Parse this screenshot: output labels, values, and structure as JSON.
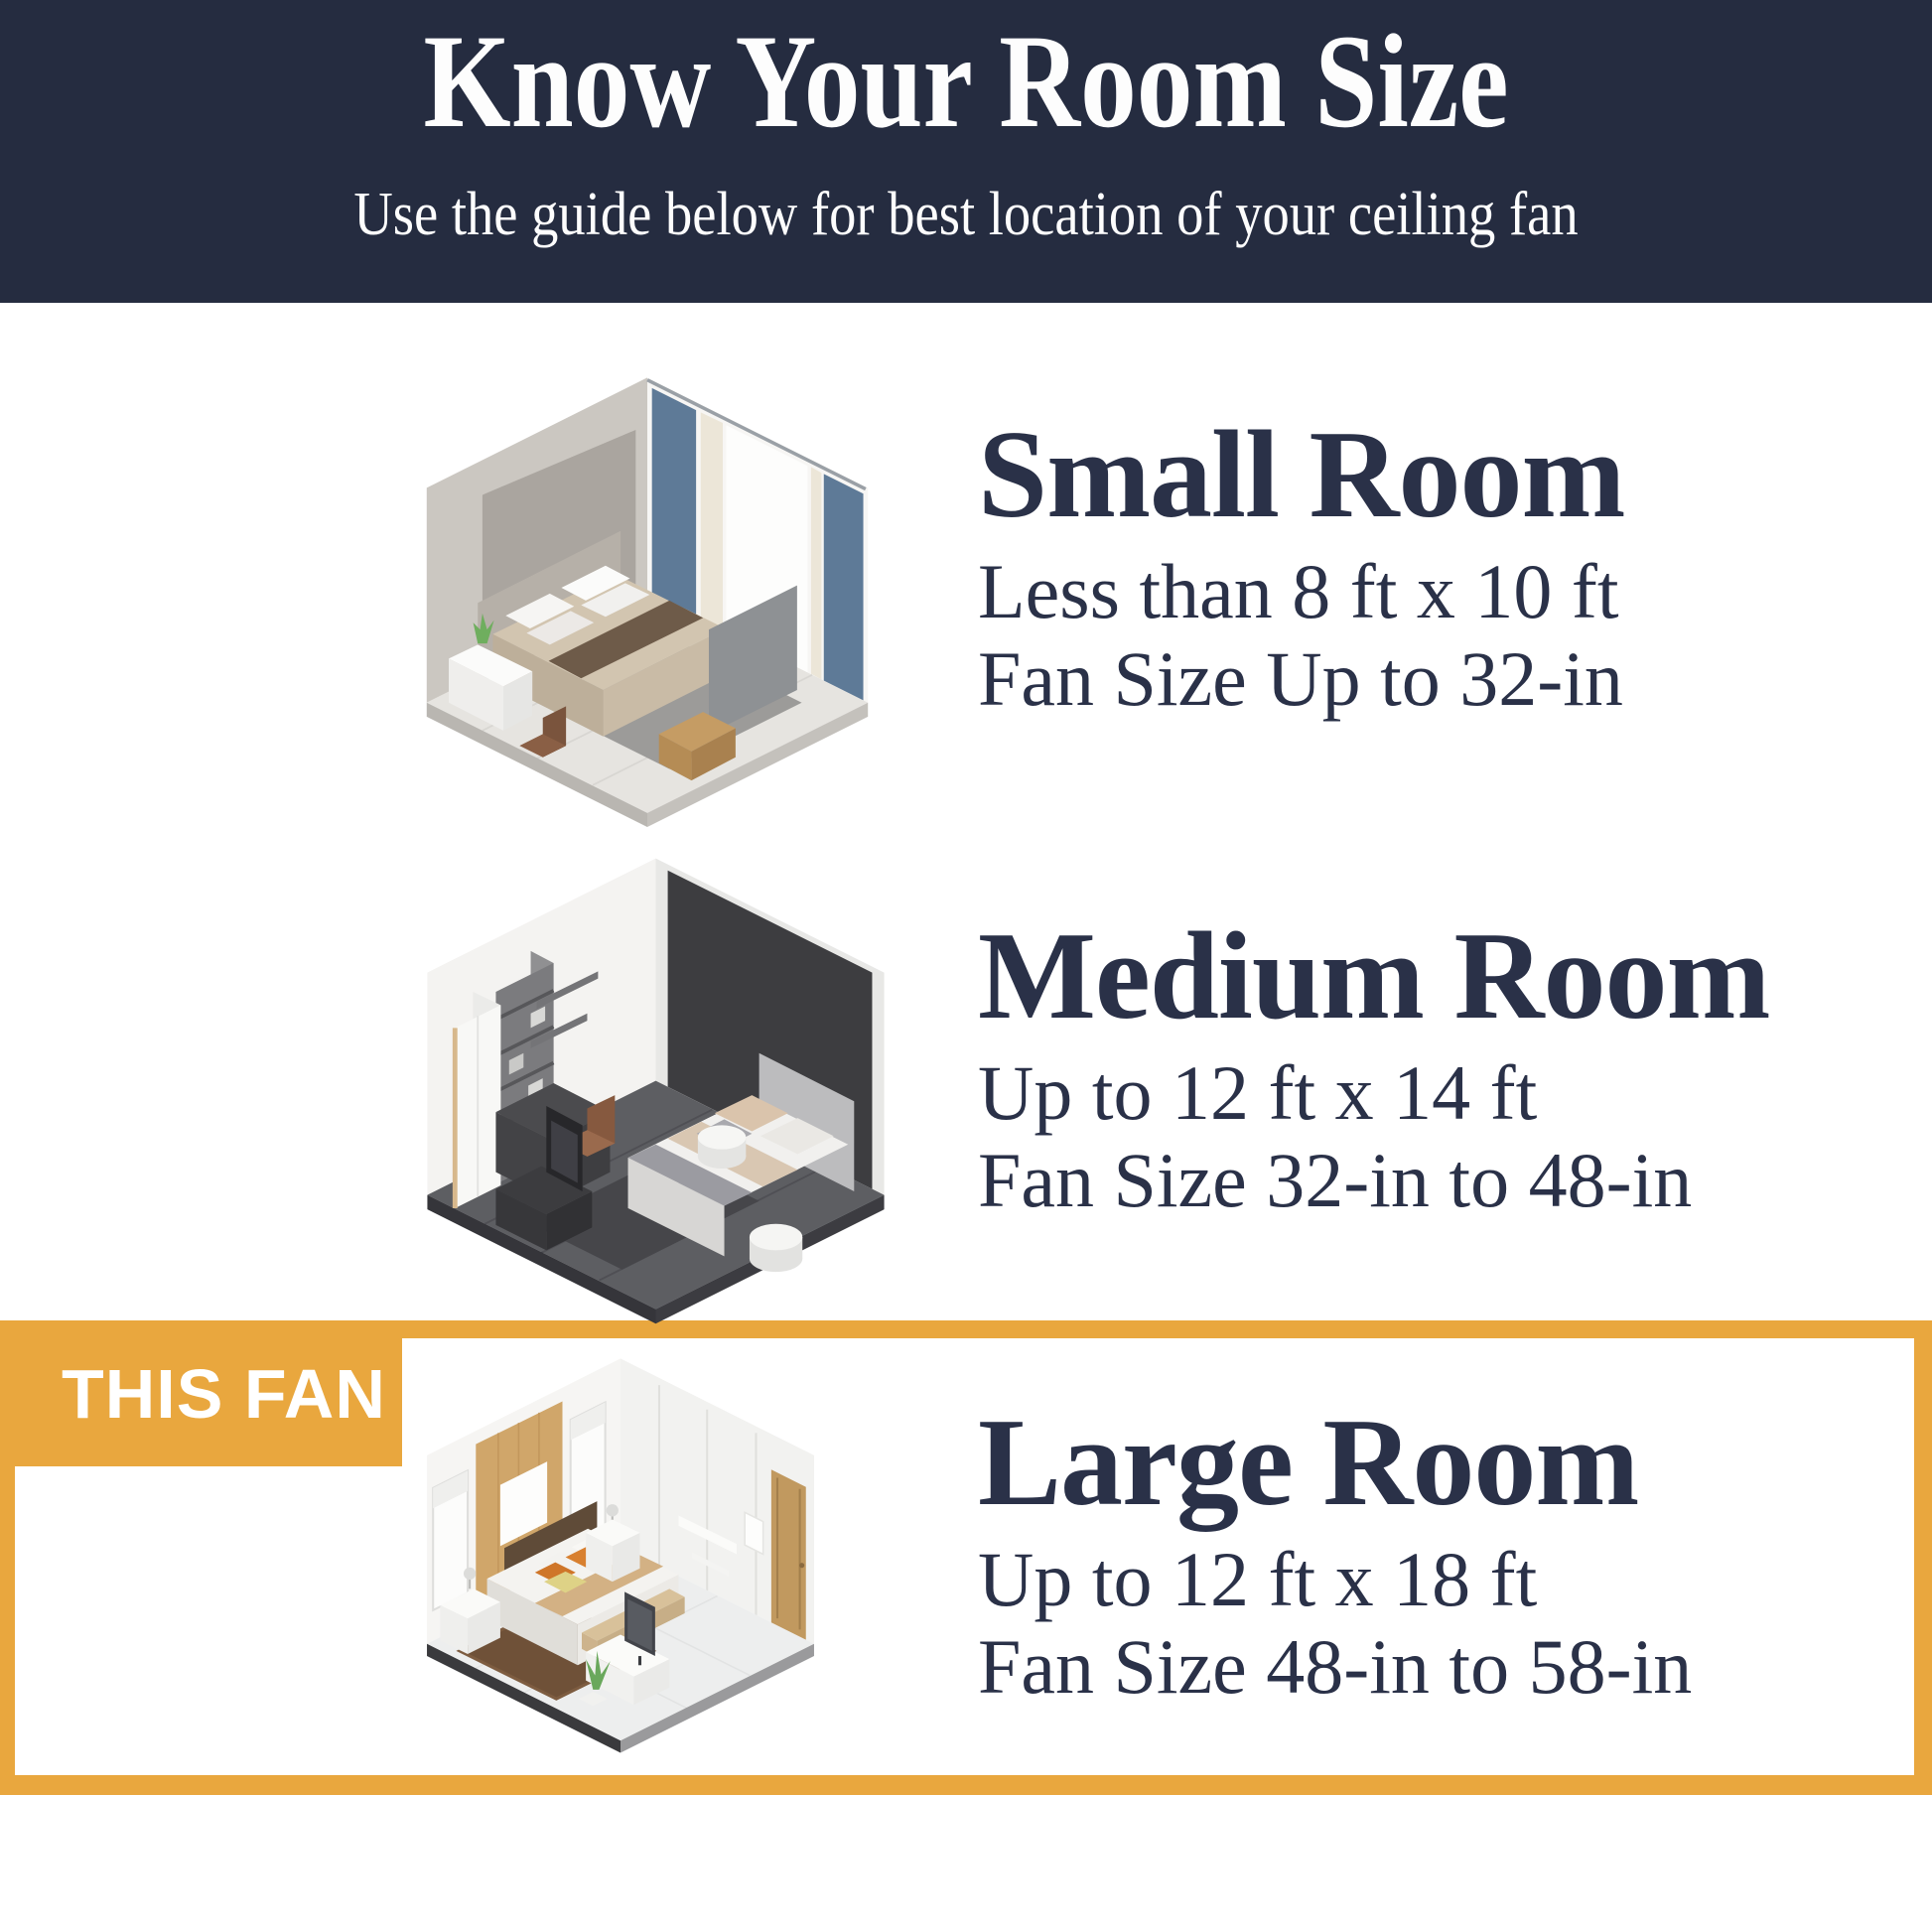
{
  "header": {
    "title": "Know Your Room Size",
    "subtitle": "Use the guide below for best location of your ceiling fan"
  },
  "badge": {
    "label": "THIS FAN"
  },
  "rooms": [
    {
      "title": "Small Room",
      "dimensions": "Less than 8 ft x 10 ft",
      "fan_size": "Fan Size Up to 32-in",
      "highlighted": false,
      "illustration": "small-bedroom-isometric"
    },
    {
      "title": "Medium Room",
      "dimensions": "Up to 12 ft x 14 ft",
      "fan_size": "Fan Size 32-in to 48-in",
      "highlighted": false,
      "illustration": "medium-bedroom-isometric"
    },
    {
      "title": "Large Room",
      "dimensions": "Up to 12 ft x 18 ft",
      "fan_size": "Fan Size 48-in to 58-in",
      "highlighted": true,
      "illustration": "large-bedroom-isometric"
    }
  ],
  "colors": {
    "header_bg": "#252c40",
    "accent_orange": "#e9a73e",
    "heading_text": "#2a3148",
    "header_text": "#fdfdfd",
    "badge_text": "#ffffff",
    "page_bg": "#ffffff"
  }
}
